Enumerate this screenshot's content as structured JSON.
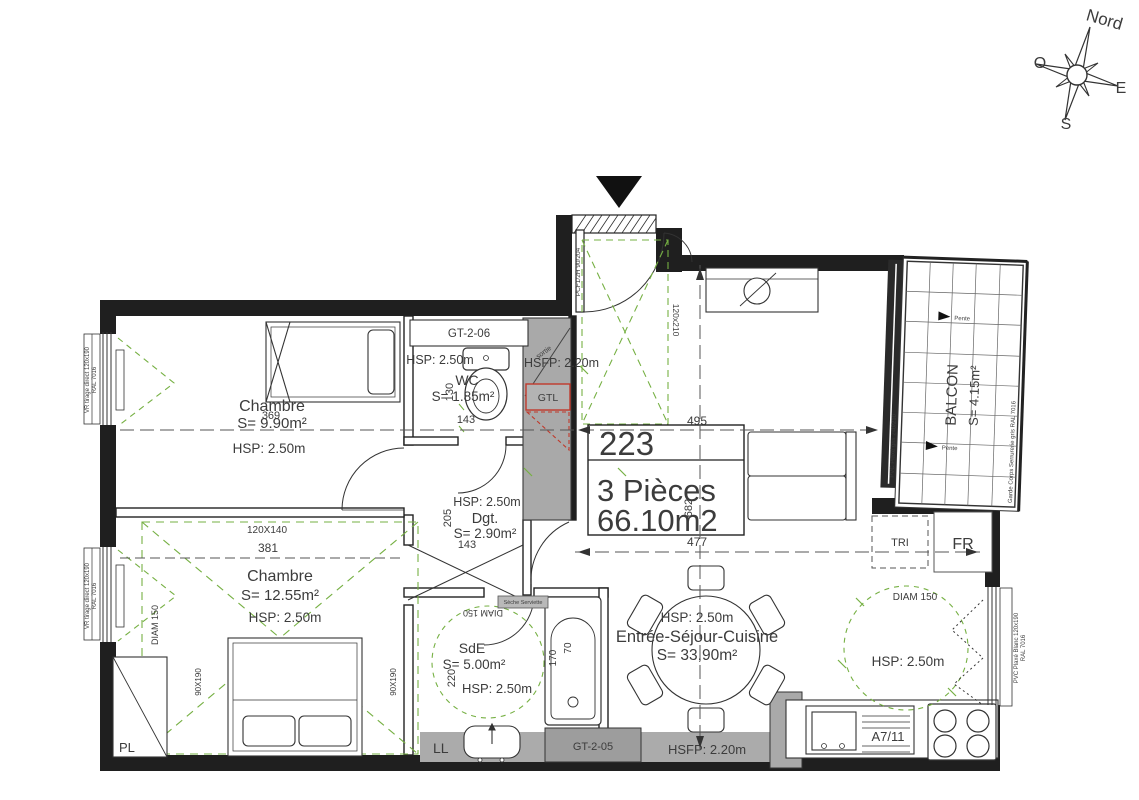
{
  "colors": {
    "wall": "#1f1f1f",
    "green": "#76b043",
    "red": "#c0392b",
    "gray_fill": "#a9a9a9",
    "text": "#3c3c3c",
    "blue_label": "#7e97b5"
  },
  "compass": {
    "north": "Nord",
    "west": "O",
    "east": "E",
    "south": "S"
  },
  "unit_box": {
    "number": "223",
    "type": "3 Pièces",
    "area": "66.10m2"
  },
  "rooms": {
    "chambre1": {
      "name": "Chambre",
      "area": "S= 9.90m²",
      "height": "HSP: 2.50m"
    },
    "wc": {
      "name": "WC",
      "area": "S= 1.85m²",
      "height": "HSP: 2.50m"
    },
    "dgt": {
      "name": "Dgt.",
      "area": "S= 2.90m²",
      "height": "HSP: 2.50m"
    },
    "chambre2": {
      "name": "Chambre",
      "area": "S= 12.55m²",
      "height": "HSP: 2.50m"
    },
    "sde": {
      "name": "SdE",
      "area": "S= 5.00m²",
      "height": "HSP: 2.50m"
    },
    "sejour": {
      "name": "Entrée-Séjour-Cuisine",
      "area": "S= 33,90m²",
      "height": "HSP: 2.50m",
      "height2": "HSP: 2.50m"
    },
    "balcon": {
      "name": "BALCON",
      "area": "S= 4.15m²"
    }
  },
  "technical": {
    "gt206": "GT-2-06",
    "gt205": "GT-2-05",
    "gt204": "GT-2-04",
    "gtl": "GTL",
    "tri": "TRI",
    "fr": "FR",
    "pl": "PL",
    "ll": "LL",
    "a711": "A7/11",
    "sortie": "sortie",
    "seche_serviette": "Sèche Serviette",
    "hsfp_gaine": "HSFP: 2.20m",
    "hsfp_kitchen": "HSFP: 2.20m",
    "pente1": "Pente",
    "pente2": "Pente"
  },
  "green_annotations": {
    "entry_door": "PCF1/2H 90/204",
    "entry_zone": "120x210",
    "chambre2_zone": "120X140",
    "diam_sde": "DIAM 150",
    "diam_sejour": "DIAM 150",
    "diam_chambre2": "DIAM 150",
    "c2_left": "90X190",
    "c2_right": "90X190"
  },
  "dimensions": {
    "chambre1": "369",
    "chambre2": "381",
    "sejour_top": "495",
    "sejour_bottom": "477",
    "sejour_vertical": "682",
    "wc_v": "130",
    "wc_h": "143",
    "dgt_v": "205",
    "dgt_h": "143",
    "sde_v": "220",
    "bath_l": "170",
    "bath_w": "70"
  },
  "window_specs": {
    "left_top": "VR tirage direct 120x190",
    "left_top2": "RAL 7016",
    "left_bottom": "VR tirage direct 120x190",
    "left_bottom2": "RAL 7016",
    "balcony_left": "PVC Plaxé gris 240/210",
    "balcony_right": "Garde Corps Serrurerie gris RAL 7016",
    "right1": "PVC Plaxé Blanc 120x190",
    "right2": "RAL 7016"
  }
}
